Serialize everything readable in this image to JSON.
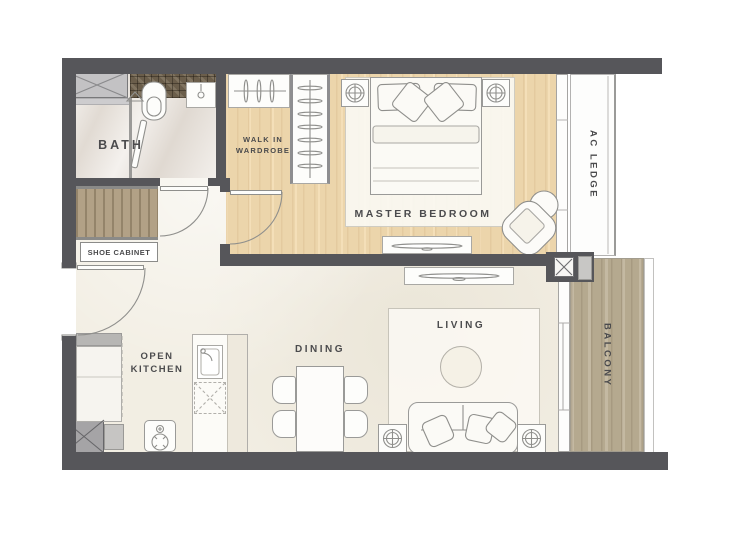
{
  "title": "1-Bedroom Apartment Floor Plan",
  "rooms": {
    "bath": "BATH",
    "walk_in_wardrobe": [
      "WALK IN",
      "WARDROBE"
    ],
    "master_bedroom": "MASTER BEDROOM",
    "ac_ledge": "AC LEDGE",
    "shoe_cabinet": "SHOE CABINET",
    "open_kitchen": [
      "OPEN",
      "KITCHEN"
    ],
    "dining": "DINING",
    "living": "LIVING",
    "balcony": "BALCONY"
  },
  "colors": {
    "wall": "#56565a",
    "wood_light": "#ecd5ab",
    "wood_balcony": "#b5a98f",
    "wood_cabinet": "#b2a186",
    "floor_cream": "#f2eee3",
    "floor_marble": "#e9e3dc",
    "counter_mosaic": "#6b5e4b",
    "line": "#8f8f8c",
    "label_text": "#4b4b4d"
  }
}
